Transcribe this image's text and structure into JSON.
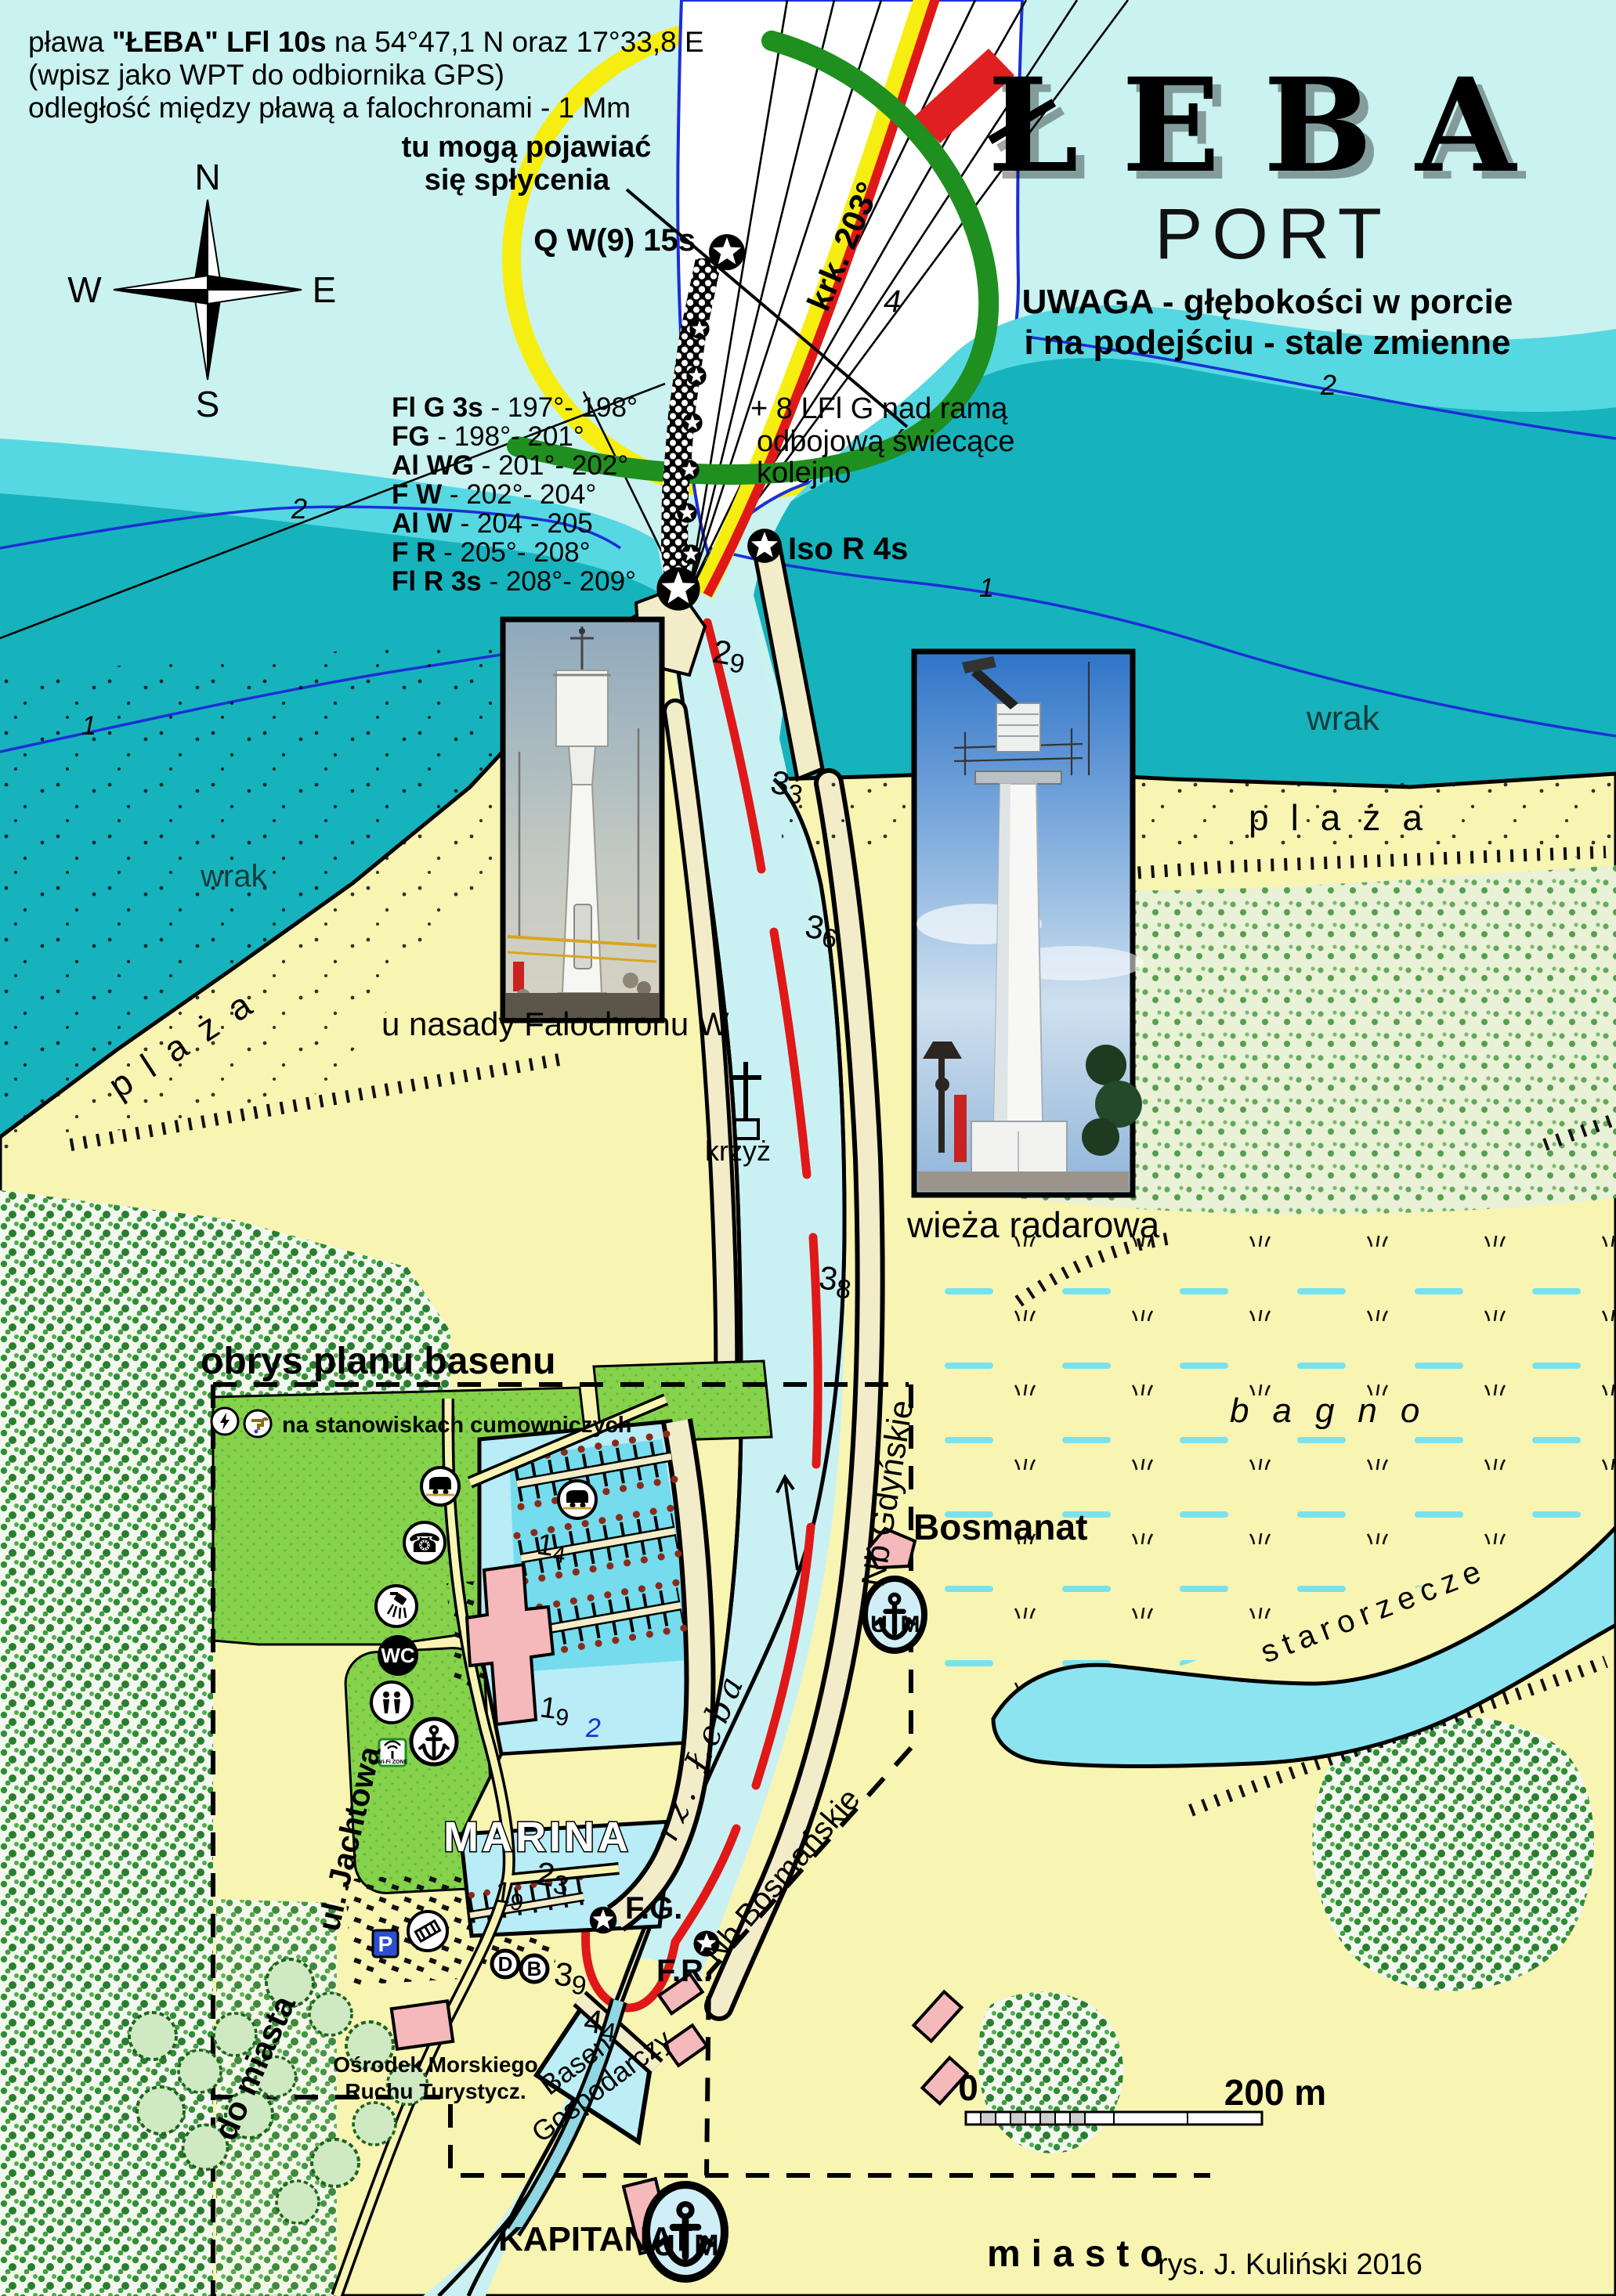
{
  "title": {
    "main": "ŁEBA",
    "sub": "PORT",
    "warning1": "UWAGA - głębokości w porcie",
    "warning2": "i na podejściu - stale zmienne"
  },
  "notes": {
    "buoy_line1_pre": "pława ",
    "buoy_line1_bold": "\"ŁEBA\" LFl 10s",
    "buoy_line1_post": " na 54°47,1 N oraz 17°33,8 E",
    "buoy_line2": "(wpisz jako WPT do odbiornika GPS)",
    "buoy_line3": "odległość między pławą a falochronami - 1 Mm",
    "shoals1": "tu mogą pojawiać",
    "shoals2": "się spłycenia",
    "west_lights1": "+ 8 LFl G nad ramą",
    "west_lights2": "odbojową świecące",
    "west_lights3": "kolejno"
  },
  "compass": {
    "n": "N",
    "e": "E",
    "s": "S",
    "w": "W"
  },
  "lights": {
    "buoy": "Q W(9) 15s",
    "course": "krk. 203°",
    "east_head": "Iso R 4s",
    "fg": "F.G.",
    "fr": "F.R.",
    "sectors": [
      {
        "t": "Fl G 3s",
        "r": " - 197°- 198°"
      },
      {
        "t": "FG",
        "r": " - 198°- 201°"
      },
      {
        "t": "Al WG",
        "r": " - 201°- 202°"
      },
      {
        "t": "F W",
        "r": " - 202°- 204°"
      },
      {
        "t": "Al W",
        "r": "  - 204 - 205"
      },
      {
        "t": "F R",
        "r": "  - 205°- 208°"
      },
      {
        "t": "Fl R 3s",
        "r": " - 208°- 209°"
      }
    ]
  },
  "depths": {
    "c4": "4",
    "c2_left": "2",
    "c2_right": "2",
    "c1_left": "1",
    "c1_right": "1",
    "marina_2": "2",
    "soundings": [
      {
        "m": "2",
        "s": "9"
      },
      {
        "m": "3",
        "s": "3"
      },
      {
        "m": "3",
        "s": "6"
      },
      {
        "m": "3",
        "s": "8"
      },
      {
        "m": "1",
        "s": "4"
      },
      {
        "m": "1",
        "s": "9"
      },
      {
        "m": "1",
        "s": "9"
      },
      {
        "m": "2",
        "s": "3"
      },
      {
        "m": "3",
        "s": "9"
      },
      {
        "m": "4",
        "s": "4"
      }
    ]
  },
  "places": {
    "wrak_left": "wrak",
    "wrak_right": "wrak",
    "plaza_left": "plaża",
    "plaza_right": "plaża",
    "bagno": "bagno",
    "starorzecze": "starorzecze",
    "miasto": "miasto",
    "marina": "MARINA",
    "bosmanat": "Bosmanat",
    "kapitanat": "KAPITANAT",
    "basen1": "Basen",
    "basen2": "Gospodarczy",
    "osrodek1": "Ośrodek Morskiego",
    "osrodek2": "Ruchu Turystycz.",
    "krzyz": "krzyż",
    "wieza": "wieża radarowa",
    "u_nasady": "u nasady Falochronu W",
    "obrys": "obrys planu basenu",
    "na_stanowiskach": "na stanowiskach cumowniczych",
    "rz_leba": "rz. Łeba",
    "nb_gdynskie": "Nb Gdyńskie",
    "nb_bosmanskie": "Nb Bosmańskie",
    "ul_jachtowa": "ul. Jachtowa",
    "do_miasta": "do miasta"
  },
  "marina_icons": {
    "wc": "WC",
    "parking": "P",
    "d": "D",
    "b": "B",
    "wifi": "Wi-Fi ZONE"
  },
  "emblem": {
    "u": "U",
    "m": "M"
  },
  "scale": {
    "zero": "0",
    "max": "200 m"
  },
  "credit": "rys. J. Kuliński 2016"
}
